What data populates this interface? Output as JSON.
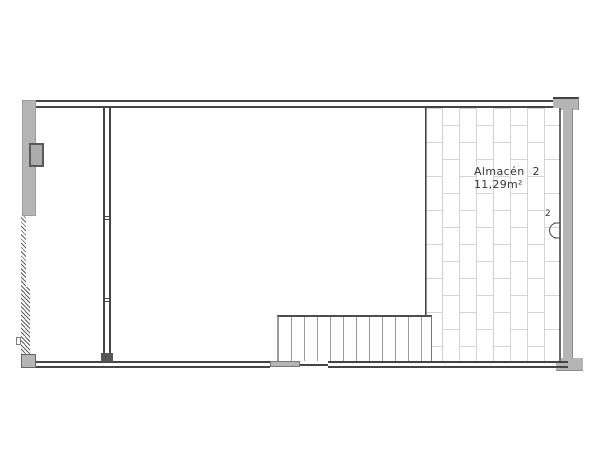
{
  "floorplan": {
    "room": {
      "label": "Almacén 2",
      "area": "11,29m²"
    },
    "marker": {
      "label": "2"
    },
    "colors": {
      "wall_line": "#454545",
      "wall_fill": "#b5b5b5",
      "tile_line": "#d4d4d4",
      "stair_line": "#9a9a9a",
      "text": "#353535"
    }
  }
}
